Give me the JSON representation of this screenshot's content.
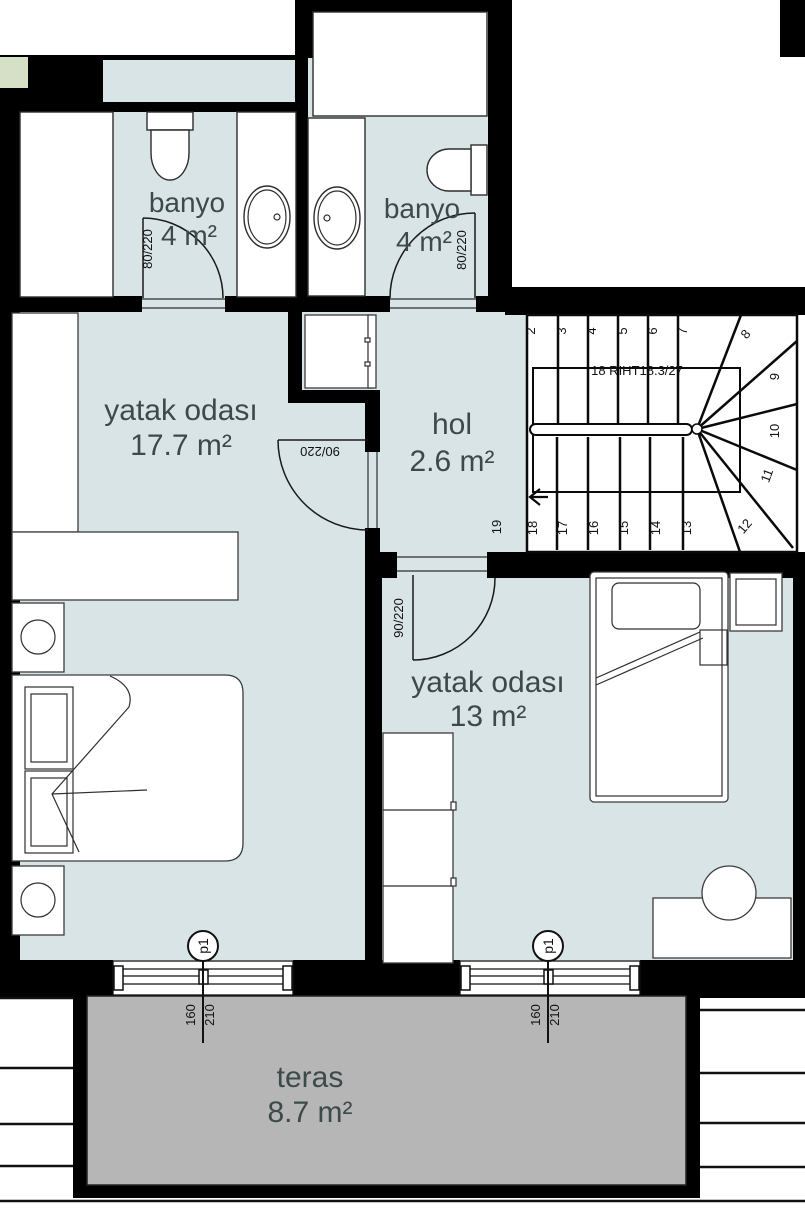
{
  "title": "apartment-floor-plan",
  "rooms": {
    "bathroom1": {
      "name": "banyo",
      "area": "4 m²"
    },
    "bathroom2": {
      "name": "banyo",
      "area": "4 m²"
    },
    "bedroom1": {
      "name": "yatak odası",
      "area": "17.7 m²"
    },
    "hall": {
      "name": "hol",
      "area": "2.6 m²"
    },
    "bedroom2": {
      "name": "yatak odası",
      "area": "13 m²"
    },
    "terrace": {
      "name": "teras",
      "area": "8.7 m²"
    }
  },
  "doors": {
    "bathroom1": "80/220",
    "bathroom2": "80/220",
    "bedroom1": "90/220",
    "bedroom2": "90/220"
  },
  "windows": {
    "marker": "p1",
    "width": "160",
    "height": "210"
  },
  "stairs": {
    "note": "18 RIHT18.3/27",
    "numbers": [
      "2",
      "3",
      "4",
      "5",
      "6",
      "7",
      "8",
      "9",
      "10",
      "11",
      "12",
      "13",
      "14",
      "15",
      "16",
      "17",
      "18",
      "19"
    ]
  },
  "colors": {
    "floor": "#d9e4e6",
    "terrace": "#b6b6b6",
    "wall": "#000000",
    "accent_green": "#d6e0c6",
    "label_text": "#3d4a4a"
  }
}
